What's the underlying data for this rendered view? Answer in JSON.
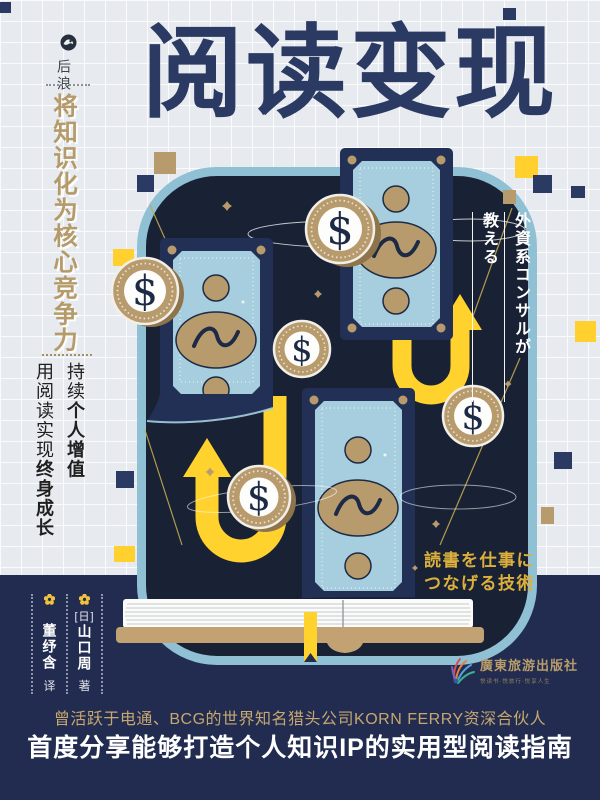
{
  "cover": {
    "title": "阅读变现",
    "imprint": {
      "name": "后浪"
    },
    "left_headline": "将知识化为核心竞争力",
    "left_sub": {
      "col1_normal": "持续",
      "col1_bold": "个人增值",
      "col2_normal": "用阅读实现",
      "col2_bold": "终身成长"
    },
    "jp_vertical": {
      "line1": "外資系コンサルが",
      "line2": "教える"
    },
    "jp_bottom": {
      "line1": "読書を仕事に",
      "line2": "つなげる技術"
    },
    "authors": {
      "origin": "[日]",
      "author": "山口周",
      "author_role": "著",
      "translator": "董纾含",
      "translator_role": "译"
    },
    "publisher": {
      "name": "廣東旅游出版社",
      "tagline": "悦读书·悦旅行·悦享人生"
    },
    "bottom": {
      "line1": "曾活跃于电通、BCG的世界知名猎头公司KORN FERRY资深合伙人",
      "line2": "首度分享能够打造个人知识IP的实用型阅读指南"
    },
    "illustration": {
      "currency_symbol": "$"
    },
    "colors": {
      "title_navy": "#2b3a63",
      "gold": "#b59a6a",
      "panel_navy": "#192235",
      "band_navy": "#212c50",
      "money_blue": "#a6cede",
      "accent_yellow": "#ffd22e",
      "coin_tan": "#b89b6d"
    }
  }
}
